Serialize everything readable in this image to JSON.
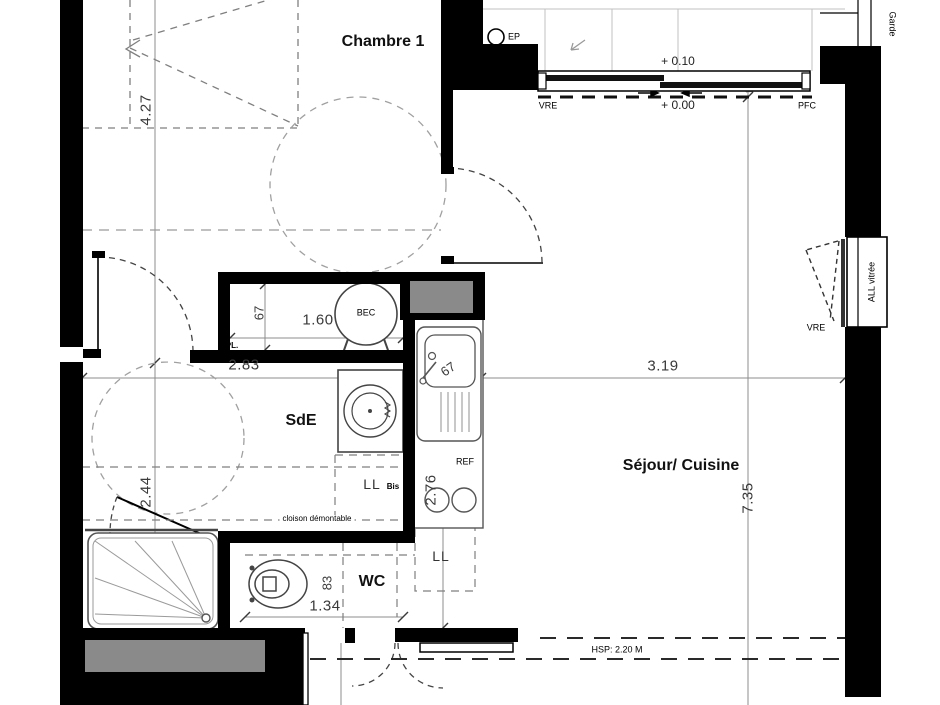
{
  "plan": {
    "rooms": {
      "chambre": "Chambre 1",
      "sde": "SdE",
      "wc": "WC",
      "sejour": "Séjour/ Cuisine"
    },
    "annotations": {
      "ep": "EP",
      "vre_top": "VRE",
      "pfc": "PFC",
      "vre_right": "VRE",
      "garde_corps": "Garde",
      "all_vitree": "ALL vitrée",
      "pl": "PL.",
      "bec": "BEC",
      "ref": "REF",
      "ll": "LL",
      "ll_bis": "LL",
      "ll_bis_suffix": "Bis",
      "cloison": "cloison démontable",
      "hsp": "HSP: 2.20 M"
    },
    "levels": {
      "upper": "+ 0.10",
      "lower": "+ 0.00"
    },
    "dimensions": {
      "d427": "4.27",
      "d283": "2.83",
      "d160": "1.60",
      "d67_closet": "67",
      "d67_kitchen": "67",
      "d319": "3.19",
      "d735": "7.35",
      "d276": "2.76",
      "d244": "2.44",
      "d83": "83",
      "d134": "1.34"
    },
    "colors": {
      "wall": "#000000",
      "duct_gray": "#8a8a8a",
      "dim_line": "#8c8c8c",
      "dash_line": "#7f7f7f",
      "background": "#ffffff"
    }
  }
}
